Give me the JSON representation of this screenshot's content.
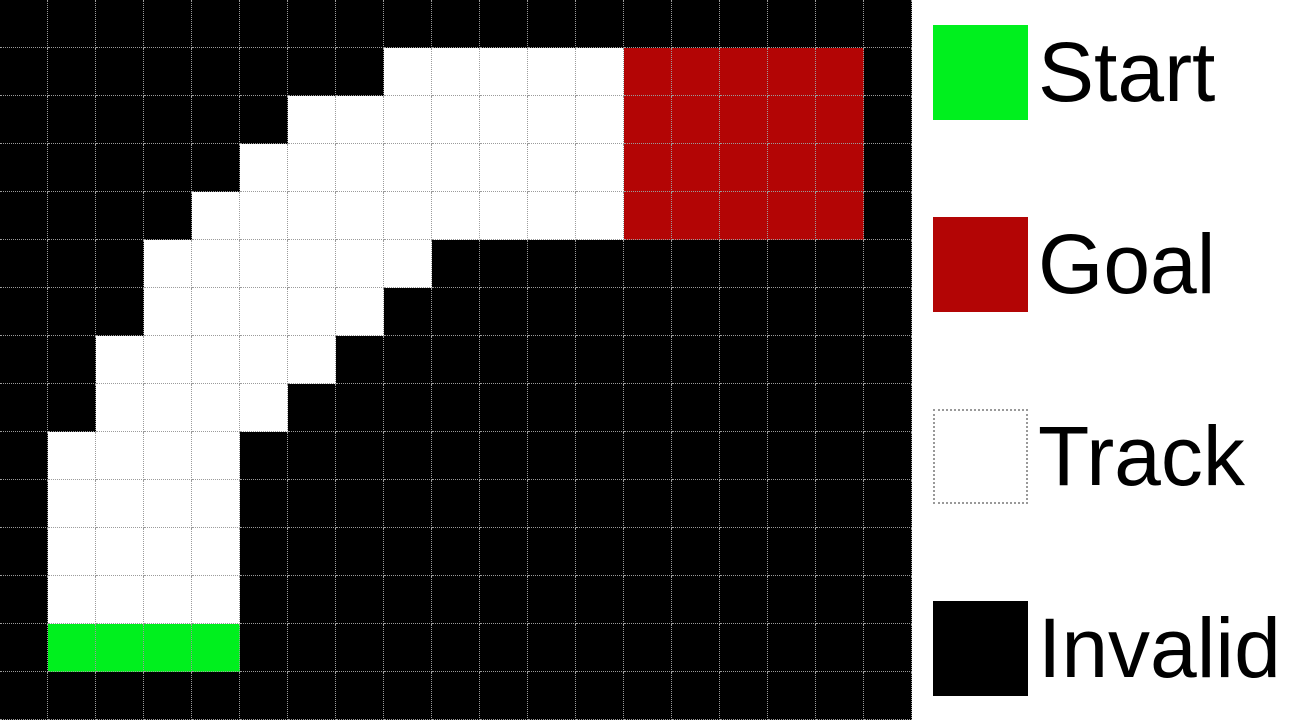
{
  "figure": {
    "grid": {
      "rows": 15,
      "cols": 19,
      "cell_size_px": 48,
      "cell_types": {
        "B": "invalid",
        "T": "track",
        "S": "start",
        "G": "goal"
      },
      "cells": [
        "BBBBBBBBBBBBBBBBBBB",
        "BBBBBBBBTTTTTGGGGGB",
        "BBBBBBTTTTTTTGGGGGB",
        "BBBBBTTTTTTTTGGGGGB",
        "BBBBTTTTTTTTTGGGGGB",
        "BBBTTTTTTBBBBBBBBBB",
        "BBBTTTTTBBBBBBBBBBB",
        "BBTTTTTBBBBBBBBBBBB",
        "BBTTTTBBBBBBBBBBBBB",
        "BTTTTBBBBBBBBBBBBBB",
        "BTTTTBBBBBBBBBBBBBB",
        "BTTTTBBBBBBBBBBBBBB",
        "BTTTTBBBBBBBBBBBBBB",
        "BSSSSBBBBBBBBBBBBBB",
        "BBBBBBBBBBBBBBBBBBB"
      ]
    },
    "colors": {
      "start": "#00F01E",
      "goal": "#B30505",
      "track": "#FFFFFF",
      "invalid": "#000000",
      "gridline": "#9B9B9B",
      "legend_background": "#FFFFFF",
      "label_text": "#000000",
      "track_swatch_border": "#999999"
    },
    "legend": {
      "items": [
        {
          "label": "Start",
          "type": "start"
        },
        {
          "label": "Goal",
          "type": "goal"
        },
        {
          "label": "Track",
          "type": "track"
        },
        {
          "label": "Invalid",
          "type": "invalid"
        }
      ]
    }
  }
}
